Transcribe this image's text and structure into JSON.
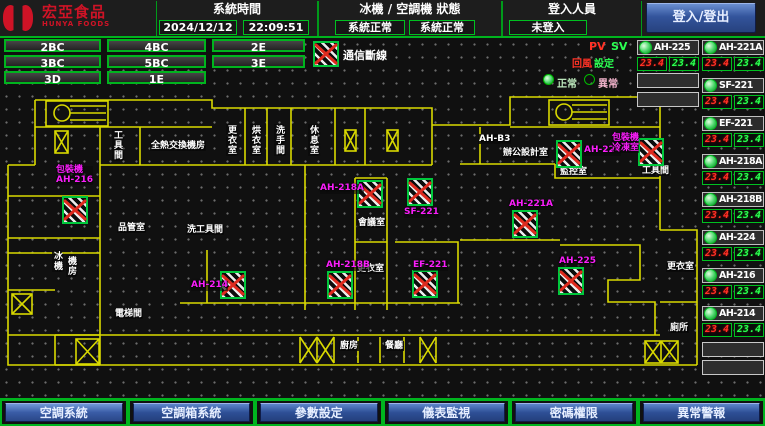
{
  "header": {
    "brand": {
      "name": "宏亞食品",
      "name_en": "HUNYA FOODS"
    },
    "time": {
      "label": "系統時間",
      "date": "2024/12/12",
      "clock": "22:09:51"
    },
    "status": {
      "label": "冰機 / 空調機 狀態",
      "chiller": "系統正常",
      "ac": "系統正常"
    },
    "login": {
      "label": "登入人員",
      "user": "未登入"
    },
    "login_button": "登入/登出"
  },
  "floor_buttons": [
    {
      "label": "2BC"
    },
    {
      "label": "4BC"
    },
    {
      "label": "2E"
    },
    {
      "label": "3BC"
    },
    {
      "label": "5BC"
    },
    {
      "label": "3E"
    },
    {
      "label": "3D"
    },
    {
      "label": "1E"
    }
  ],
  "legend": {
    "comm_loss": "通信斷線",
    "pv": "PV",
    "sv": "SV",
    "return_label": "回風",
    "set_label": "設定",
    "normal": "正常",
    "abnormal": "異常"
  },
  "unit_panel": {
    "col_a": [
      {
        "name": "AH-225",
        "pv": "23.4",
        "sv": "23.4"
      }
    ],
    "col_a_empty": 2,
    "col_b": [
      {
        "name": "AH-221A",
        "pv": "23.4",
        "sv": "23.4"
      },
      {
        "name": "SF-221",
        "pv": "23.4",
        "sv": "23.4"
      },
      {
        "name": "EF-221",
        "pv": "23.4",
        "sv": "23.4"
      },
      {
        "name": "AH-218A",
        "pv": "23.4",
        "sv": "23.4"
      },
      {
        "name": "AH-218B",
        "pv": "23.4",
        "sv": "23.4"
      },
      {
        "name": "AH-224",
        "pv": "23.4",
        "sv": "23.4"
      },
      {
        "name": "AH-216",
        "pv": "23.4",
        "sv": "23.4"
      },
      {
        "name": "AH-214",
        "pv": "23.4",
        "sv": "23.4"
      }
    ],
    "col_b_empty": 2
  },
  "map": {
    "devices": [
      {
        "id": "AH-216",
        "equip": "包裝機",
        "icon": [
          62,
          196
        ],
        "label": [
          56,
          166
        ]
      },
      {
        "id": "AH-214",
        "icon": [
          220,
          271
        ],
        "label": [
          191,
          281
        ]
      },
      {
        "id": "AH-218A",
        "icon": [
          357,
          180
        ],
        "label": [
          320,
          184
        ]
      },
      {
        "id": "SF-221",
        "icon": [
          407,
          178
        ],
        "label": [
          404,
          208
        ]
      },
      {
        "id": "AH-218B",
        "icon": [
          327,
          271
        ],
        "label": [
          326,
          261
        ]
      },
      {
        "id": "EF-221",
        "icon": [
          412,
          270
        ],
        "label": [
          413,
          261
        ]
      },
      {
        "id": "AH-221A",
        "icon": [
          512,
          210
        ],
        "label": [
          509,
          200
        ]
      },
      {
        "id": "AH-225",
        "icon": [
          558,
          267
        ],
        "label": [
          559,
          257
        ]
      },
      {
        "id": "AH-224",
        "icon": [
          556,
          140
        ],
        "label": [
          584,
          146
        ]
      },
      {
        "id": "冷凍室",
        "equip": "包裝機",
        "icon": [
          638,
          138
        ],
        "label": [
          612,
          134
        ]
      }
    ],
    "rooms": [
      {
        "t": "工具間",
        "x": 112,
        "y": 129,
        "v": 1
      },
      {
        "t": "全熱交換機房",
        "x": 150,
        "y": 141
      },
      {
        "t": "更衣室",
        "x": 226,
        "y": 124,
        "v": 1
      },
      {
        "t": "烘衣室",
        "x": 250,
        "y": 124,
        "v": 1
      },
      {
        "t": "洗手間",
        "x": 274,
        "y": 124,
        "v": 1
      },
      {
        "t": "休息室",
        "x": 308,
        "y": 124,
        "v": 1
      },
      {
        "t": "AH-B3",
        "x": 478,
        "y": 134
      },
      {
        "t": "辦公設計室",
        "x": 502,
        "y": 148
      },
      {
        "t": "監控室",
        "x": 559,
        "y": 167
      },
      {
        "t": "工具間",
        "x": 641,
        "y": 166
      },
      {
        "t": "會議室",
        "x": 357,
        "y": 218
      },
      {
        "t": "更衣室",
        "x": 356,
        "y": 264
      },
      {
        "t": "品管室",
        "x": 117,
        "y": 223
      },
      {
        "t": "洗工具間",
        "x": 186,
        "y": 225
      },
      {
        "t": "冰機",
        "x": 52,
        "y": 250,
        "v": 1
      },
      {
        "t": "機房",
        "x": 66,
        "y": 255,
        "v": 1
      },
      {
        "t": "電梯間",
        "x": 114,
        "y": 309
      },
      {
        "t": "更衣室",
        "x": 666,
        "y": 262
      },
      {
        "t": "廁所",
        "x": 669,
        "y": 323
      },
      {
        "t": "廚房",
        "x": 339,
        "y": 341
      },
      {
        "t": "餐廳",
        "x": 384,
        "y": 341
      }
    ]
  },
  "nav_buttons": [
    {
      "label": "空調系統",
      "active": true
    },
    {
      "label": "空調箱系統",
      "active": false
    },
    {
      "label": "參數設定",
      "active": false
    },
    {
      "label": "儀表監視",
      "active": false
    },
    {
      "label": "密碼權限",
      "active": false
    },
    {
      "label": "異常警報",
      "active": false
    }
  ],
  "colors": {
    "accent_green": "#00b41e",
    "wall_yellow": "#d9d900",
    "device_magenta": "#fa1efa",
    "alarm_red": "#de2a1e",
    "seg_pv_red": "#ff3226",
    "seg_sv_green": "#2bff52",
    "button_blue": "#33549c",
    "brand_red": "#cf1326"
  }
}
